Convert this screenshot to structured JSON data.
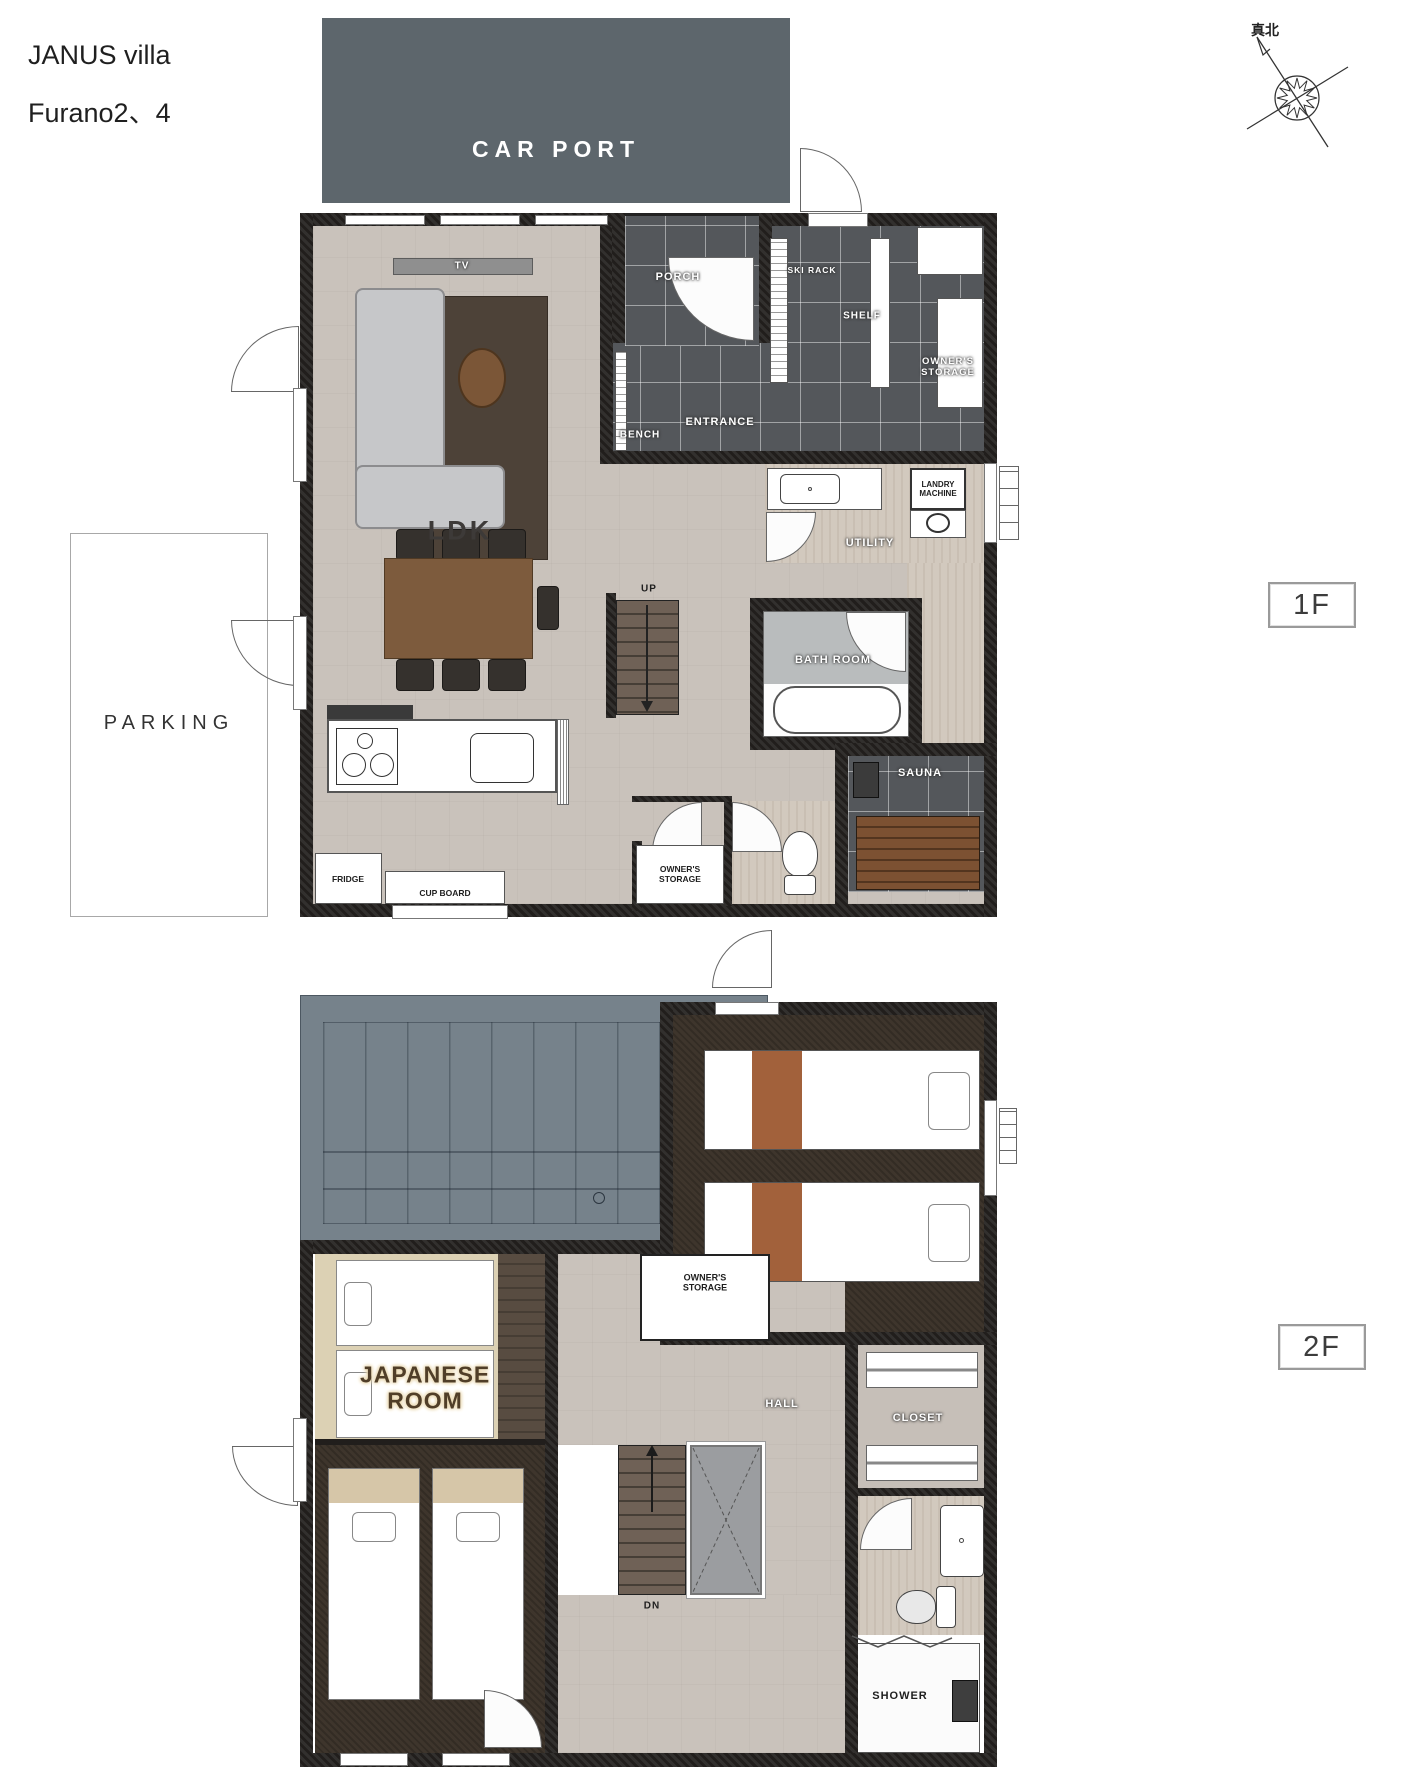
{
  "page": {
    "title_line1": "JANUS villa",
    "title_line2": "Furano2、4"
  },
  "compass": {
    "label": "真北"
  },
  "exterior": {
    "carport": "CAR PORT",
    "parking": "PARKING"
  },
  "floor1": {
    "badge": "1F",
    "labels": {
      "tv": "TV",
      "porch": "PORCH",
      "ski_rack": "SKI RACK",
      "shelf": "SHELF",
      "owners_storage_top": "OWNER'S STORAGE",
      "bench": "BENCH",
      "entrance": "ENTRANCE",
      "ldk": "LDK",
      "landry_machine": "LANDRY MACHINE",
      "utility": "UTILITY",
      "up": "UP",
      "bath_room": "BATH ROOM",
      "sauna": "SAUNA",
      "fridge": "FRIDGE",
      "cup_board": "CUP BOARD",
      "owners_storage_bottom": "OWNER'S STORAGE"
    }
  },
  "floor2": {
    "badge": "2F",
    "labels": {
      "owners_storage": "OWNER'S STORAGE",
      "japanese_room": "JAPANESE ROOM",
      "hall": "HALL",
      "closet": "CLOSET",
      "dn": "DN",
      "shower": "SHOWER"
    }
  },
  "colors": {
    "carport": "#5d666c",
    "roof": "#76828b",
    "wall": "#211e1c",
    "entrance_tile": "#54575b",
    "ldk_floor": "#c9c2bb",
    "utility_floor": "#d2c9be",
    "bedroom_floor": "#3e352c",
    "tatami": "#dcd1b4",
    "table_wood": "#7c5a3c",
    "sauna_wood": "#7c5132",
    "bed_stripe": "#a2613b",
    "bath_gray": "#b9bcbd"
  }
}
